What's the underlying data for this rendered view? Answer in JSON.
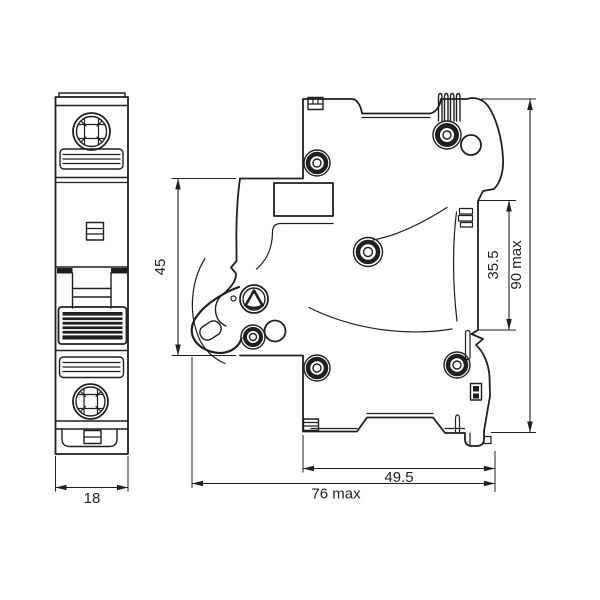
{
  "drawing": {
    "colors": {
      "line": "#1f1f1f",
      "background": "#ffffff"
    },
    "dimensions": {
      "front_width": "18",
      "handle_recess_height": "45",
      "din_slot_height": "35.5",
      "overall_height": "90 max",
      "body_depth": "49.5",
      "overall_depth": "76 max"
    }
  }
}
